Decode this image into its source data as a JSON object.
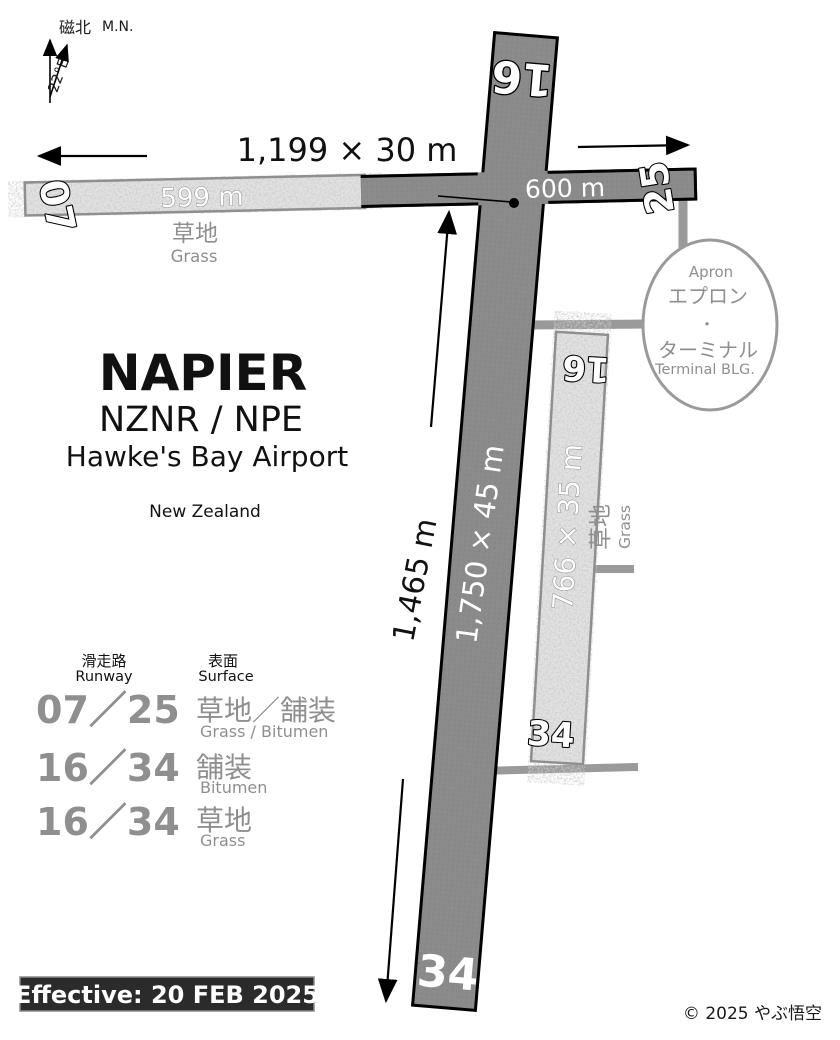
{
  "compass": {
    "label_jp": "磁北",
    "label_en": "M.N.",
    "variation": "22°E"
  },
  "title_block": {
    "city": "NAPIER",
    "codes": "NZNR / NPE",
    "airport_name": "Hawke's Bay Airport",
    "country": "New Zealand"
  },
  "runway_07_25": {
    "dimension": "1,199 × 30 m",
    "grass_length": "599 m",
    "bitumen_length": "600 m",
    "end_07": "07",
    "end_25": "25",
    "surface_label_jp": "草地",
    "surface_label_en": "Grass"
  },
  "runway_16_34_bitumen": {
    "dimension": "1,750 × 45 m",
    "length_from_intersection": "1,465 m",
    "end_16": "16",
    "end_34": "34"
  },
  "runway_16_34_grass": {
    "dimension": "766 × 35 m",
    "end_16": "16",
    "end_34": "34",
    "surface_label_jp": "草地",
    "surface_label_en": "Grass"
  },
  "apron": {
    "label_en": "Apron",
    "label_jp": "エプロン",
    "separator": "・",
    "terminal_jp": "ターミナル",
    "terminal_en": "Terminal BLG."
  },
  "runway_table": {
    "col_runway_jp": "滑走路",
    "col_runway_en": "Runway",
    "col_surface_jp": "表面",
    "col_surface_en": "Surface",
    "rows": [
      {
        "runway": "07／25",
        "surface_jp": "草地／舗装",
        "surface_en": "Grass / Bitumen"
      },
      {
        "runway": "16／34",
        "surface_jp": "舗装",
        "surface_en": "Bitumen"
      },
      {
        "runway": "16／34",
        "surface_jp": "草地",
        "surface_en": "Grass"
      }
    ]
  },
  "footer": {
    "effective_date": "Effective: 20 FEB 2025",
    "copyright": "© 2025 やぶ悟空"
  },
  "colors": {
    "bitumen": "#8b8b8b",
    "grass_fill": "#e2e2e2",
    "outline": "#000000",
    "taxiway": "#9a9a9a",
    "muted_text": "#8f8f8f",
    "effective_bg": "#2b2b2b",
    "effective_text": "#ffffff"
  }
}
